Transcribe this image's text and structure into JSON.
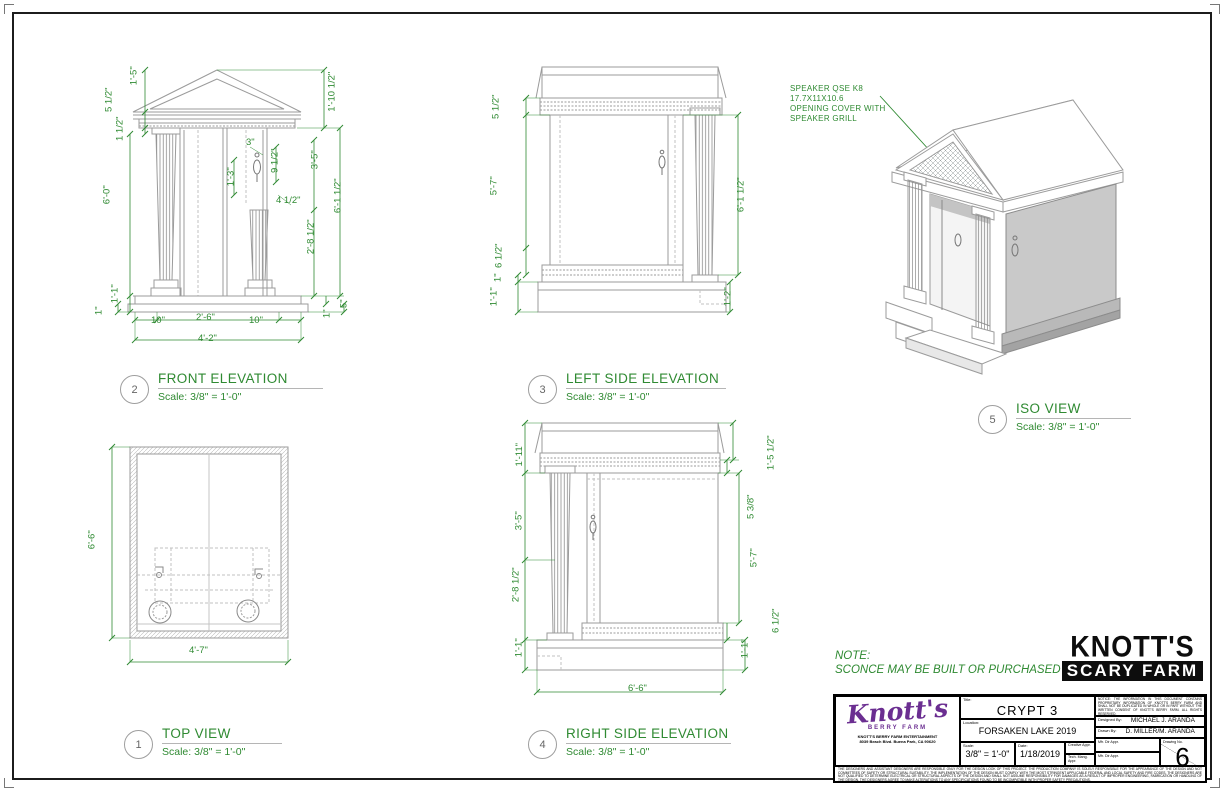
{
  "views": {
    "front": {
      "num": "2",
      "title": "FRONT ELEVATION",
      "scale": "Scale: 3/8\" = 1'-0\"",
      "dims": {
        "left": [
          "1'-5\"",
          "5 1/2\"",
          "1 1/2\"",
          "6'-0\"",
          "1'-1\"",
          "1\""
        ],
        "right": [
          "1'-10 1/2\"",
          "3'-5\"",
          "6'-1 1/2\"",
          "2'-8 1/2\"",
          "1\"",
          "5\""
        ],
        "inner": [
          "3\"",
          "9 1/2\"",
          "1'-3\"",
          "4 1/2\""
        ],
        "bottom": [
          "10\"",
          "2'-6\"",
          "10\"",
          "4'-2\""
        ]
      }
    },
    "leftside": {
      "num": "3",
      "title": "LEFT SIDE ELEVATION",
      "scale": "Scale: 3/8\" = 1'-0\"",
      "dims": {
        "left": [
          "5 1/2\"",
          "5'-7\"",
          "6 1/2\"",
          "1\"",
          "1'-1\""
        ],
        "right": [
          "6'-1 1/2\"",
          "1'-2\""
        ]
      }
    },
    "top": {
      "num": "1",
      "title": "TOP VIEW",
      "scale": "Scale: 3/8\" = 1'-0\"",
      "dims": {
        "left": [
          "6'-6\""
        ],
        "bottom": [
          "4'-7\""
        ]
      }
    },
    "rightside": {
      "num": "4",
      "title": "RIGHT SIDE ELEVATION",
      "scale": "Scale: 3/8\" = 1'-0\"",
      "dims": {
        "left": [
          "1'-11\"",
          "3'-5\"",
          "2'-8 1/2\"",
          "1'-1\""
        ],
        "right": [
          "1'-5 1/2\"",
          "5 3/8\"",
          "5'-7\"",
          "6 1/2\"",
          "1'-1\""
        ],
        "bottom": [
          "6'-6\""
        ]
      }
    },
    "iso": {
      "num": "5",
      "title": "ISO VIEW",
      "scale": "Scale: 3/8\" = 1'-0\""
    }
  },
  "speaker_callout": {
    "lines": [
      "SPEAKER QSE K8",
      "17.7X11X10.6",
      "OPENING COVER WITH",
      "SPEAKER GRILL"
    ]
  },
  "note": {
    "heading": "NOTE:",
    "body": "SCONCE MAY BE BUILT OR PURCHASED"
  },
  "brand": {
    "scary_line1": "KNOTT'S",
    "scary_line2": "SCARY FARM"
  },
  "titleblock": {
    "logo": {
      "name": "Knott's",
      "sub": "BERRY FARM",
      "address1": "KNOTT'S BERRY FARM ENTERTAINMENT",
      "address2": "8039 Beach Blvd. Buena Park, CA 90620"
    },
    "title_label": "Title:",
    "title": "CRYPT 3",
    "location_label": "Location:",
    "location": "FORSAKEN LAKE 2019",
    "scale_label": "Scale:",
    "scale": "3/8\" = 1'-0\"",
    "date_label": "Date:",
    "date": "1/18/2019",
    "creative_label": "Creative Appr.",
    "tech_label": "Tech. Mang. Appr.",
    "designed_label": "Designed By:",
    "designed": "MICHAEL J. ARANDA",
    "drawn_label": "Drawn By:",
    "drawn": "D. MILLER/M. ARANDA",
    "mfr1_label": "Mfr. Dir Appr.",
    "mfr2_label": "Mfr. Dir Appr.",
    "drawing_no_label": "Drawing No.",
    "drawing_no": "6",
    "notice": "NOTICE: THE INFORMATION IN THIS DOCUMENT CONTAINS PROPRIETARY INFORMATION OF KNOTT'S BERRY FARM AND SHALL NOT BE DUPLICATED IN WHOLE OR IN PART WITHOUT THE WRITTEN CONSENT OF KNOTT'S BERRY FARM. ALL RIGHTS RESERVED.",
    "disclaimer": "THE DESIGNERS AND ASSISTANT DESIGNERS ARE RESPONSIBLE ONLY FOR THE DESIGN LOOK OF THIS PROJECT. THE PRODUCTION COMPANY IS SOLELY RESPONSIBLE FOR THE APPEARANCE OF THE DESIGN AND NOT COMMITTEES OF SAFETY OR STRUCTURAL SUITABILITY. THE IMPLEMENTATION OF THE DESIGN MUST COMPLY WITH THE MOST STRINGENT APPLICABLE FEDERAL AND LOCAL SAFETY AND FIRE CODES. THE DESIGNERS ARE NOT QUALIFIED TO DETERMINE ELECTRICAL OR STRUCTURAL ASPECTS OF THE DESIGN AND SHALL NOT ASSUME RESPONSIBILITY FOR DAMAGES AS A RESULT OF IMPROPER ENGINEERING, FABRICATION OR HANDLING OF THE DESIGN. THE DESIGNERS AGREE TO MAKE ALTERATIONS TO ANY SPECIFICATIONS FOUND TO BE INCOMPATIBLE WITH PROPER SAFETY PRECAUTIONS."
  }
}
